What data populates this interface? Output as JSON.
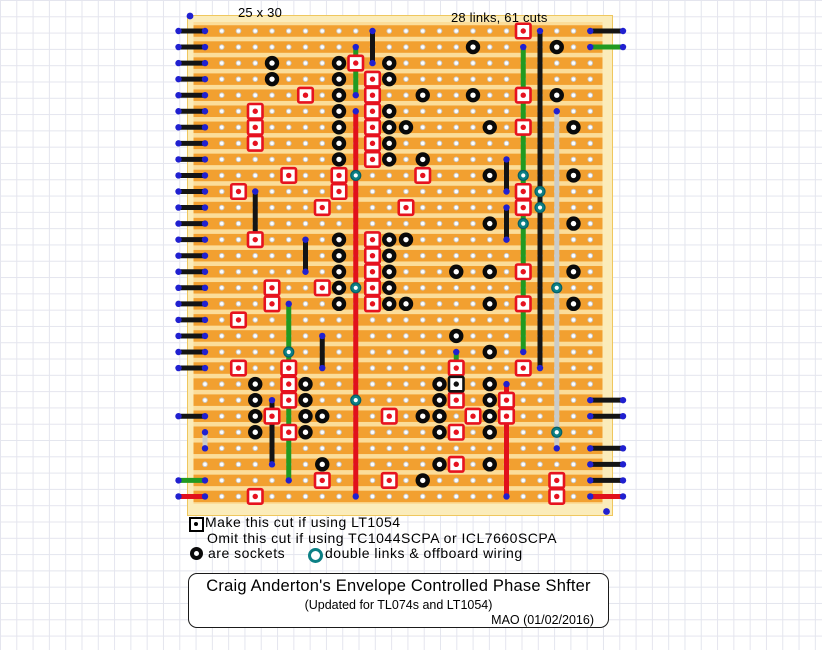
{
  "labels": {
    "board_size": "25 x 30",
    "links_cuts": "28 links, 61 cuts"
  },
  "legend": {
    "line1": "Make this cut if using LT1054",
    "line2": "Omit this cut if using TC1044SCPA or ICL7660SCPA",
    "sockets_label": "are sockets",
    "double_links_label": "double links & offboard wiring",
    "cut_marker_icon": "black-square-cut-icon",
    "socket_icon": "black-socket-icon",
    "double_link_icon": "teal-ring-icon"
  },
  "title_block": {
    "title": "Craig Anderton's Envelope Controlled Phase Shfter",
    "subtitle": "(Updated for TL074s and LT1054)",
    "author_date": "MAO (01/02/2016)"
  },
  "colors": {
    "board_edge": "#fbecba",
    "board_edge_line": "#efc75e",
    "strip_orange": "#f2a030",
    "strip_gap": "#fbdd9a",
    "hole_fill": "#ffffff",
    "hole_ring": "#c8c8c8",
    "socket": "#0a0a0a",
    "cut_red": "#e6121f",
    "special_cut_black": "#111111",
    "link_green": "#219a21",
    "link_red": "#e1101c",
    "link_black": "#141414",
    "link_gray": "#c9cbc9",
    "teal_ring": "#0c8085",
    "teal_ring_dark": "#065f66",
    "solder_dot_blue": "#2020d0",
    "wire_black": "#0f0f0f"
  },
  "diagram": {
    "cols": 25,
    "rows": 30,
    "origin_x": 205,
    "origin_y": 31,
    "dx": 16.75,
    "dy": 16.05,
    "hole_cols_drawn": 24,
    "board": {
      "pale": [
        187.5,
        15.5,
        425,
        500
      ],
      "orange": [
        193.5,
        22,
        409,
        482
      ],
      "strip_h": 11.5
    },
    "wire_left_x": 178.5,
    "wire_right_x": 623,
    "wires_left": [
      {
        "row": 1,
        "color": "black"
      },
      {
        "row": 2,
        "color": "black"
      },
      {
        "row": 3,
        "color": "black"
      },
      {
        "row": 4,
        "color": "black"
      },
      {
        "row": 5,
        "color": "black"
      },
      {
        "row": 6,
        "color": "black"
      },
      {
        "row": 7,
        "color": "black"
      },
      {
        "row": 8,
        "color": "black"
      },
      {
        "row": 9,
        "color": "black"
      },
      {
        "row": 10,
        "color": "black"
      },
      {
        "row": 11,
        "color": "black"
      },
      {
        "row": 12,
        "color": "black"
      },
      {
        "row": 13,
        "color": "black"
      },
      {
        "row": 14,
        "color": "black"
      },
      {
        "row": 15,
        "color": "black"
      },
      {
        "row": 16,
        "color": "black"
      },
      {
        "row": 17,
        "color": "black"
      },
      {
        "row": 18,
        "color": "black"
      },
      {
        "row": 19,
        "color": "black"
      },
      {
        "row": 20,
        "color": "black"
      },
      {
        "row": 21,
        "color": "black"
      },
      {
        "row": 22,
        "color": "black"
      },
      {
        "row": 25,
        "color": "black"
      },
      {
        "row": 29,
        "color": "green"
      },
      {
        "row": 30,
        "color": "red"
      }
    ],
    "wires_right": [
      {
        "row": 1,
        "color": "black"
      },
      {
        "row": 2,
        "color": "green"
      },
      {
        "row": 24,
        "color": "black"
      },
      {
        "row": 25,
        "color": "black"
      },
      {
        "row": 27,
        "color": "black"
      },
      {
        "row": 28,
        "color": "black"
      },
      {
        "row": 29,
        "color": "black"
      },
      {
        "row": 30,
        "color": "red"
      }
    ],
    "links": [
      {
        "col": 11,
        "from": 1,
        "to": 3,
        "color": "black"
      },
      {
        "col": 10,
        "from": 2,
        "to": 5,
        "color": "green"
      },
      {
        "col": 10,
        "from": 6,
        "to": 30,
        "color": "red"
      },
      {
        "col": 4,
        "from": 11,
        "to": 14,
        "color": "black"
      },
      {
        "col": 7,
        "from": 14,
        "to": 16,
        "color": "black"
      },
      {
        "col": 8,
        "from": 20,
        "to": 22,
        "color": "black"
      },
      {
        "col": 5,
        "from": 24,
        "to": 28,
        "color": "black"
      },
      {
        "col": 6,
        "from": 18,
        "to": 29,
        "color": "green"
      },
      {
        "col": 16,
        "from": 21,
        "to": 24,
        "color": "green"
      },
      {
        "col": 19,
        "from": 9,
        "to": 11,
        "color": "black"
      },
      {
        "col": 19,
        "from": 12,
        "to": 14,
        "color": "black"
      },
      {
        "col": 19,
        "from": 23,
        "to": 30,
        "color": "red"
      },
      {
        "col": 20,
        "from": 2,
        "to": 21,
        "color": "green"
      },
      {
        "col": 21,
        "from": 1,
        "to": 22,
        "color": "black"
      },
      {
        "col": 22,
        "from": 6,
        "to": 27,
        "color": "gray"
      },
      {
        "col": 1,
        "from": 26,
        "to": 27,
        "color": "gray"
      }
    ],
    "sockets": [
      [
        5,
        3
      ],
      [
        5,
        4
      ],
      [
        9,
        3
      ],
      [
        9,
        4
      ],
      [
        9,
        5
      ],
      [
        9,
        6
      ],
      [
        9,
        7
      ],
      [
        9,
        8
      ],
      [
        9,
        9
      ],
      [
        9,
        14
      ],
      [
        9,
        15
      ],
      [
        9,
        16
      ],
      [
        9,
        17
      ],
      [
        9,
        18
      ],
      [
        12,
        3
      ],
      [
        12,
        4
      ],
      [
        12,
        6
      ],
      [
        12,
        7
      ],
      [
        12,
        8
      ],
      [
        12,
        9
      ],
      [
        12,
        14
      ],
      [
        12,
        15
      ],
      [
        12,
        16
      ],
      [
        12,
        17
      ],
      [
        12,
        18
      ],
      [
        13,
        7
      ],
      [
        13,
        14
      ],
      [
        13,
        18
      ],
      [
        14,
        5
      ],
      [
        14,
        9
      ],
      [
        14,
        25
      ],
      [
        14,
        29
      ],
      [
        15,
        23
      ],
      [
        15,
        24
      ],
      [
        15,
        25
      ],
      [
        15,
        26
      ],
      [
        15,
        28
      ],
      [
        16,
        16
      ],
      [
        16,
        20
      ],
      [
        17,
        2
      ],
      [
        17,
        5
      ],
      [
        18,
        7
      ],
      [
        18,
        10
      ],
      [
        18,
        13
      ],
      [
        18,
        16
      ],
      [
        18,
        18
      ],
      [
        18,
        21
      ],
      [
        18,
        23
      ],
      [
        18,
        24
      ],
      [
        18,
        25
      ],
      [
        18,
        26
      ],
      [
        18,
        28
      ],
      [
        22,
        2
      ],
      [
        22,
        5
      ],
      [
        23,
        7
      ],
      [
        23,
        10
      ],
      [
        23,
        13
      ],
      [
        23,
        16
      ],
      [
        23,
        18
      ],
      [
        4,
        23
      ],
      [
        4,
        24
      ],
      [
        4,
        25
      ],
      [
        4,
        26
      ],
      [
        7,
        23
      ],
      [
        7,
        24
      ],
      [
        7,
        25
      ],
      [
        7,
        26
      ],
      [
        8,
        25
      ],
      [
        8,
        28
      ]
    ],
    "cuts": [
      [
        10,
        3
      ],
      [
        11,
        4
      ],
      [
        11,
        5
      ],
      [
        11,
        6
      ],
      [
        11,
        7
      ],
      [
        11,
        8
      ],
      [
        11,
        9
      ],
      [
        11,
        14
      ],
      [
        11,
        15
      ],
      [
        11,
        16
      ],
      [
        11,
        17
      ],
      [
        11,
        18
      ],
      [
        20,
        1
      ],
      [
        20,
        5
      ],
      [
        20,
        7
      ],
      [
        20,
        11
      ],
      [
        20,
        12
      ],
      [
        20,
        16
      ],
      [
        20,
        18
      ],
      [
        20,
        22
      ],
      [
        7,
        5
      ],
      [
        4,
        6
      ],
      [
        4,
        7
      ],
      [
        4,
        8
      ],
      [
        6,
        10
      ],
      [
        9,
        10
      ],
      [
        14,
        10
      ],
      [
        3,
        11
      ],
      [
        9,
        11
      ],
      [
        8,
        12
      ],
      [
        13,
        12
      ],
      [
        4,
        14
      ],
      [
        5,
        17
      ],
      [
        8,
        17
      ],
      [
        5,
        18
      ],
      [
        3,
        19
      ],
      [
        3,
        22
      ],
      [
        6,
        22
      ],
      [
        16,
        22
      ],
      [
        6,
        23
      ],
      [
        6,
        24
      ],
      [
        16,
        24
      ],
      [
        19,
        24
      ],
      [
        5,
        25
      ],
      [
        12,
        25
      ],
      [
        17,
        25
      ],
      [
        19,
        25
      ],
      [
        6,
        26
      ],
      [
        16,
        26
      ],
      [
        16,
        28
      ],
      [
        8,
        29
      ],
      [
        12,
        29
      ],
      [
        22,
        29
      ],
      [
        4,
        30
      ],
      [
        22,
        30
      ]
    ],
    "special_cuts": [
      [
        16,
        23
      ]
    ],
    "teal_rings": [
      [
        10,
        10
      ],
      [
        10,
        17
      ],
      [
        10,
        24
      ],
      [
        20,
        10
      ],
      [
        20,
        13
      ],
      [
        21,
        11
      ],
      [
        21,
        12
      ],
      [
        22,
        17
      ],
      [
        22,
        26
      ],
      [
        6,
        21
      ]
    ],
    "stray_dots": [
      [
        190,
        16
      ],
      [
        606.5,
        511.5
      ]
    ]
  }
}
